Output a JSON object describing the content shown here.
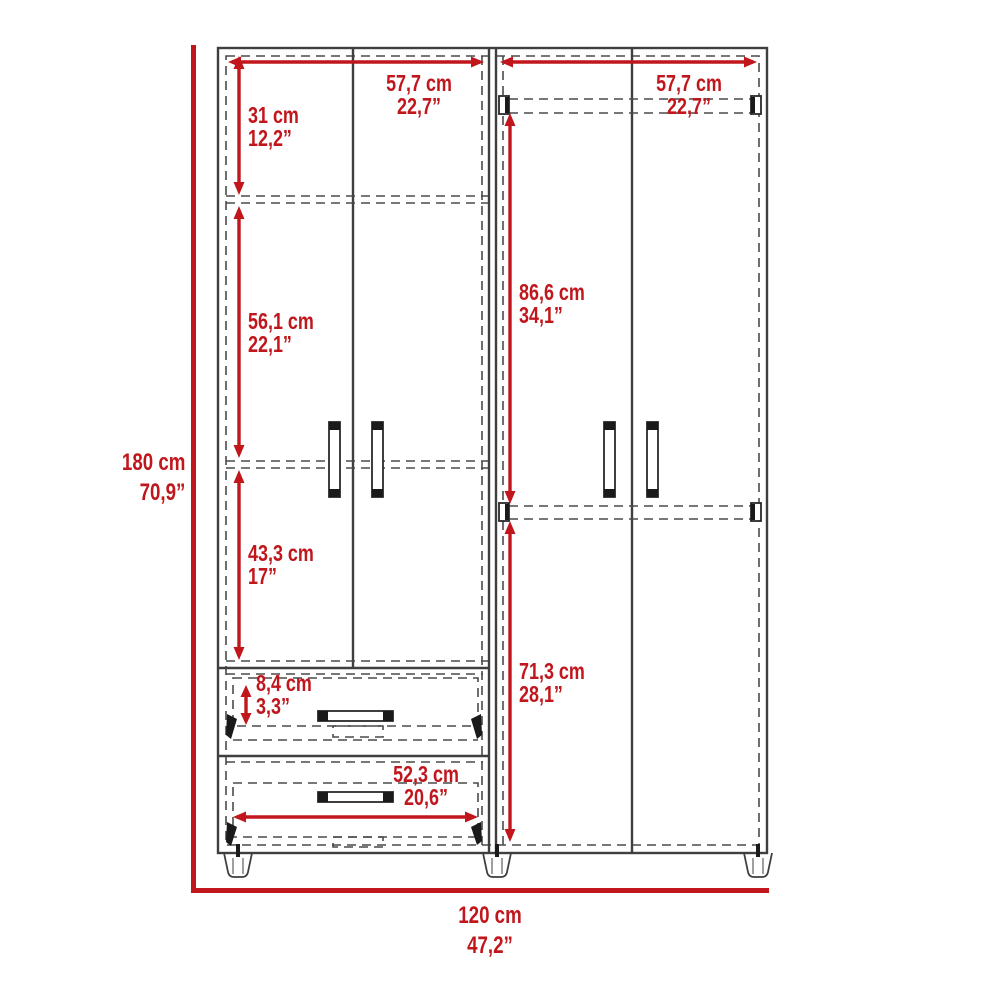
{
  "diagram": {
    "type": "furniture-dimension-diagram",
    "subject": "armoire-wardrobe-front-view",
    "units": [
      "cm",
      "inches"
    ],
    "colors": {
      "dimension_red": "#c0161c",
      "outline_dark": "#3f3f3f",
      "dashed_gray": "#4a4a4a",
      "background": "#ffffff"
    },
    "dimensions": {
      "height_total": {
        "cm": "180 cm",
        "inch": "70,9”"
      },
      "width_total": {
        "cm": "120 cm",
        "inch": "47,2”"
      },
      "left_section_width": {
        "cm": "57,7 cm",
        "inch": "22,7”"
      },
      "right_section_width": {
        "cm": "57,7 cm",
        "inch": "22,7”"
      },
      "top_compartment": {
        "cm": "31 cm",
        "inch": "12,2”"
      },
      "middle_compartment": {
        "cm": "56,1 cm",
        "inch": "22,1”"
      },
      "lower_compartment": {
        "cm": "43,3 cm",
        "inch": "17”"
      },
      "drawer_face_height": {
        "cm": "8,4 cm",
        "inch": "3,3”"
      },
      "drawer_width": {
        "cm": "52,3 cm",
        "inch": "20,6”"
      },
      "right_upper_section": {
        "cm": "86,6 cm",
        "inch": "34,1”"
      },
      "right_lower_section": {
        "cm": "71,3 cm",
        "inch": "28,1”"
      }
    }
  }
}
